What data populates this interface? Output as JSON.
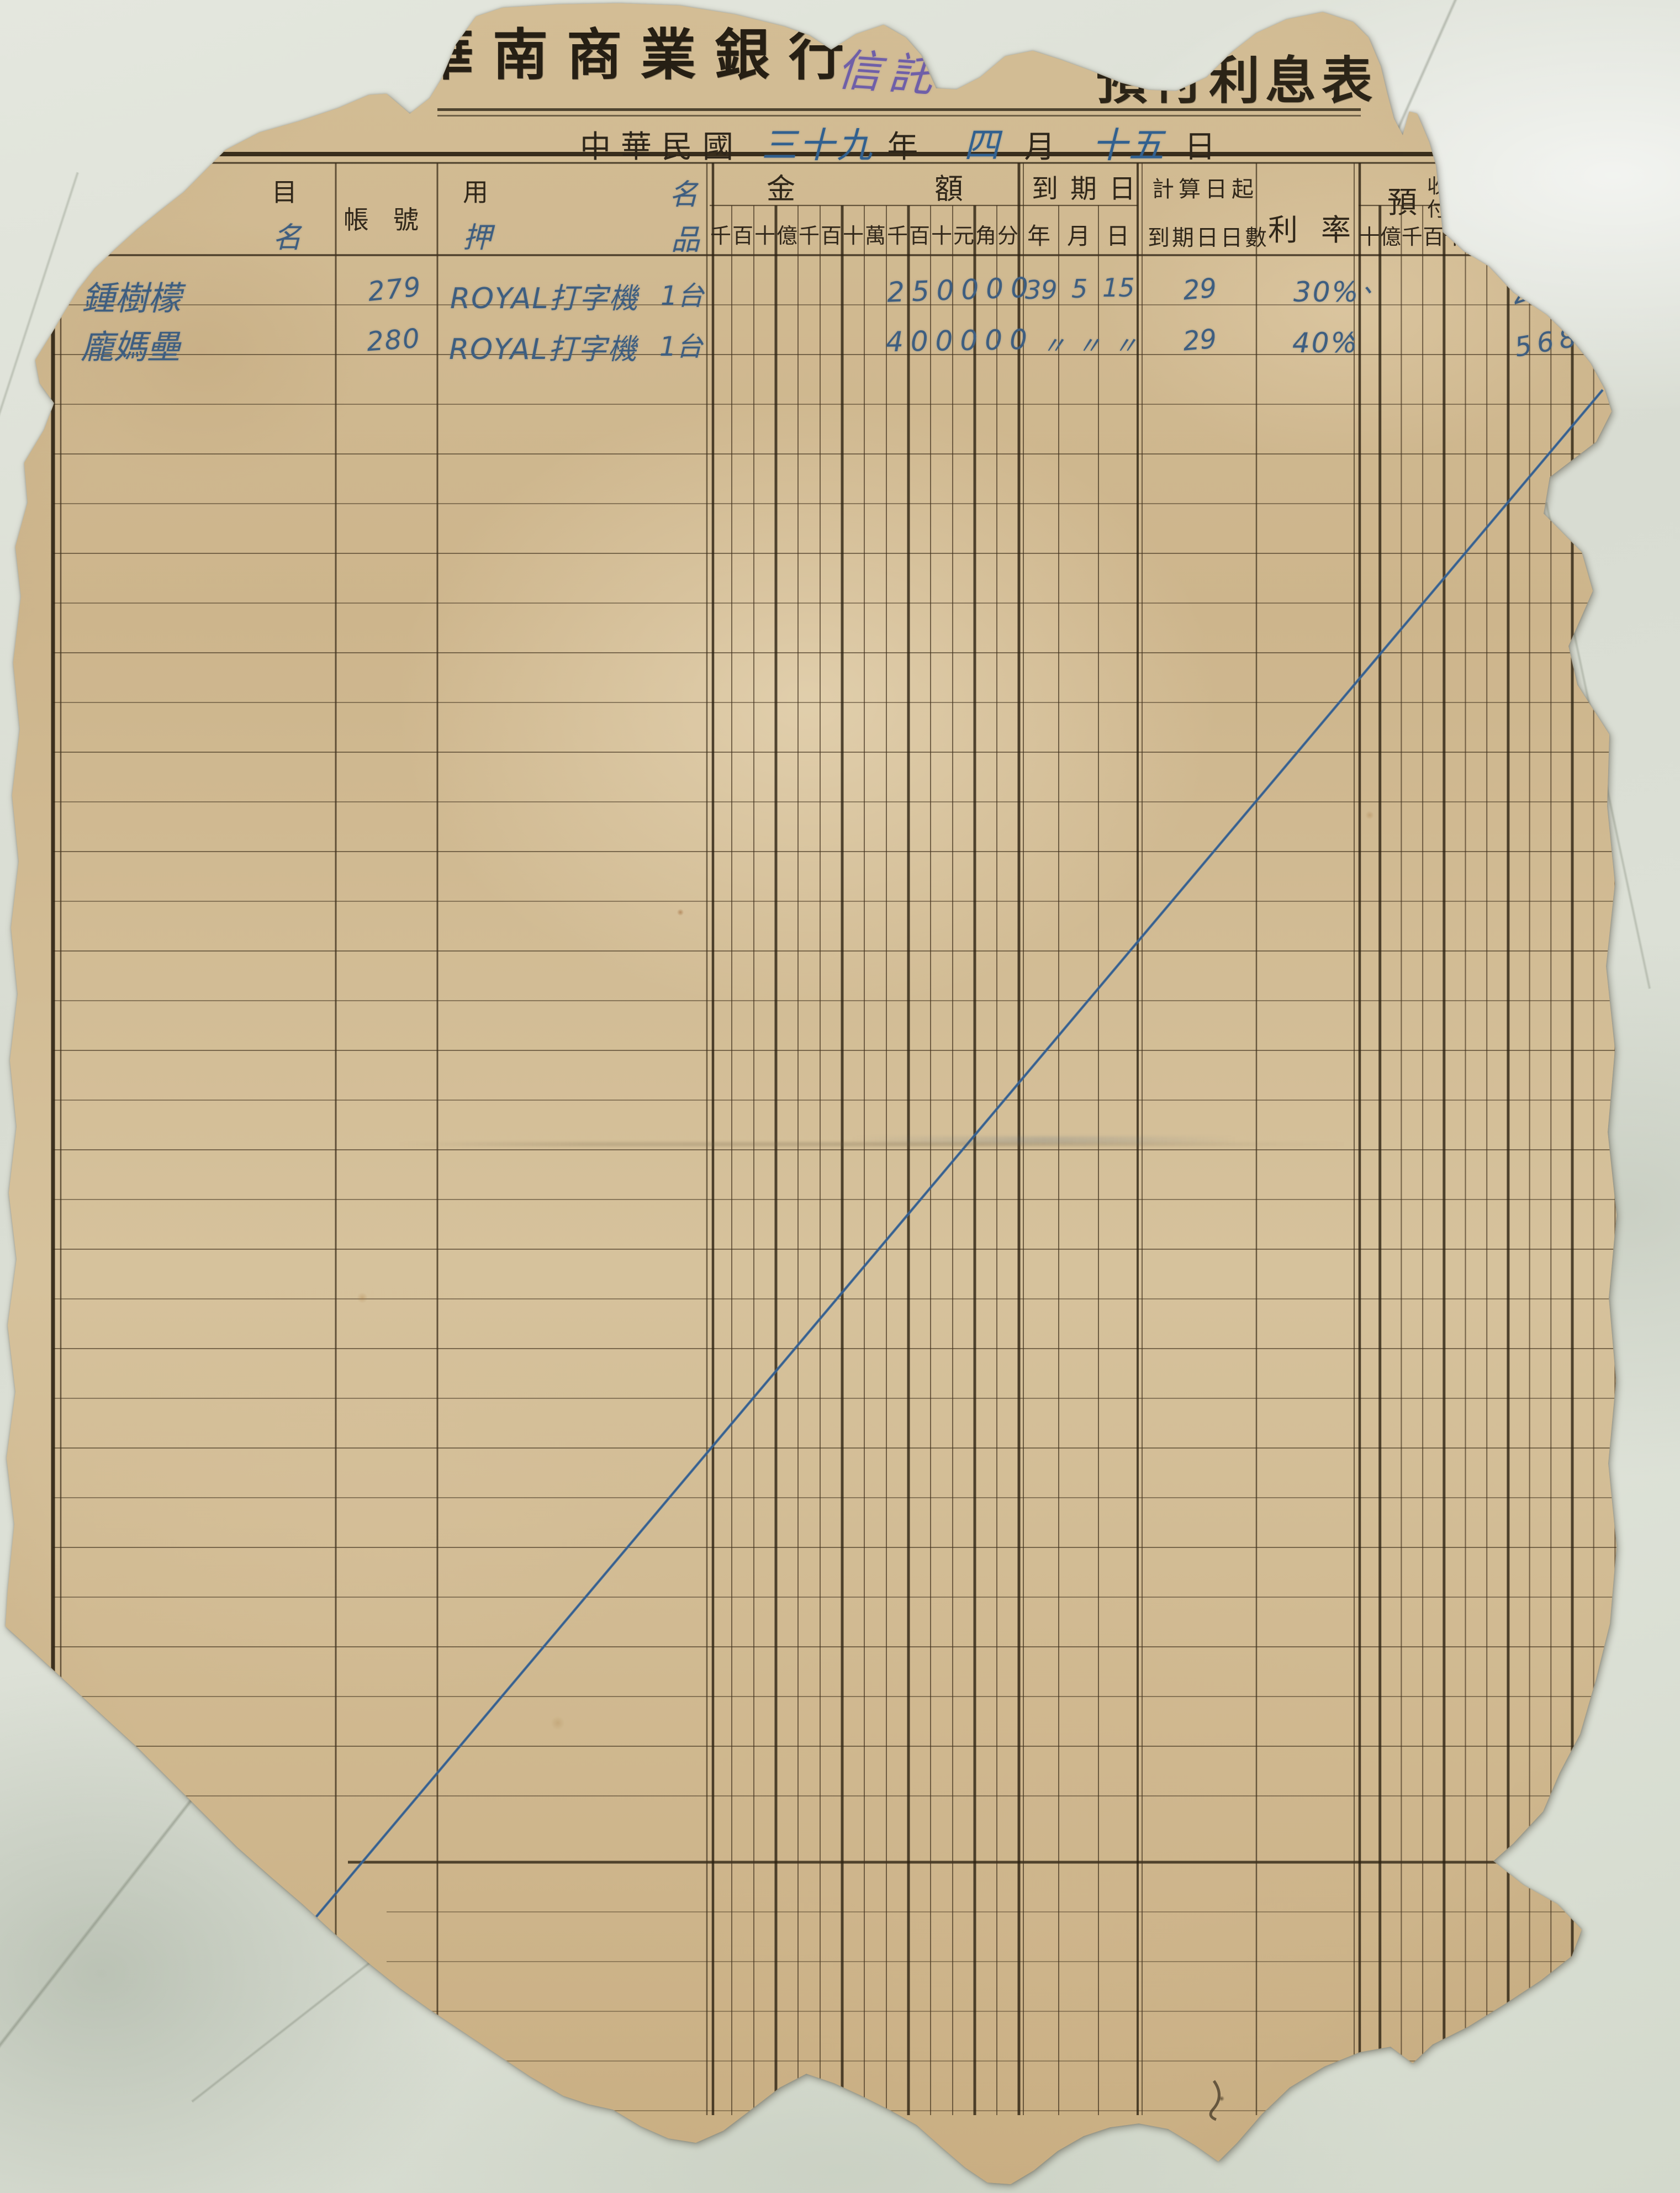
{
  "header": {
    "bank_name": "華南商業銀行",
    "trust_annotation": "信託",
    "form_title": "預付利息表",
    "date": {
      "era": "中華民國",
      "year": "三十九",
      "year_unit": "年",
      "month": "四",
      "month_unit": "月",
      "day": "十五",
      "day_unit": "日"
    }
  },
  "table": {
    "col_subject_printed": "目",
    "col_subject_hand": "名",
    "col_account": "帳號",
    "col_use_printed": "用",
    "col_use_hand": "押",
    "col_name_hand": "名",
    "col_item_hand": "品",
    "amount_group": [
      "金",
      "額"
    ],
    "amount_units": [
      "千",
      "百",
      "十",
      "億",
      "千",
      "百",
      "十",
      "萬",
      "千",
      "百",
      "十",
      "元",
      "角",
      "分"
    ],
    "due_group": "到期日",
    "due_units": [
      "年",
      "月",
      "日"
    ],
    "calc_label_top": "計算日起",
    "calc_label_bottom": "到期日日數",
    "rate_group": [
      "利",
      "率"
    ],
    "prepaid_label": "預",
    "prepaid_receive": "收",
    "prepaid_pay": "付",
    "prepaid_interest": "利",
    "prepaid_units": [
      "十",
      "億",
      "千",
      "百",
      "十",
      "萬",
      "千"
    ]
  },
  "rows": [
    {
      "name": "鍾樹檬",
      "account": "279",
      "item": "ROYAL打字機",
      "qty": "1台",
      "amount": "250000",
      "due_year": "39",
      "due_month": "5",
      "due_day": "15",
      "days": "29",
      "rate": "30%",
      "tick": "、",
      "prepaid": "21"
    },
    {
      "name": "龐媽壘",
      "account": "280",
      "item": "ROYAL打字機",
      "qty": "1台",
      "amount": "400000",
      "due_year": "〃",
      "due_month": "〃",
      "due_day": "〃",
      "days": "29",
      "rate": "40%",
      "tick": "、",
      "prepaid": "5684"
    }
  ]
}
